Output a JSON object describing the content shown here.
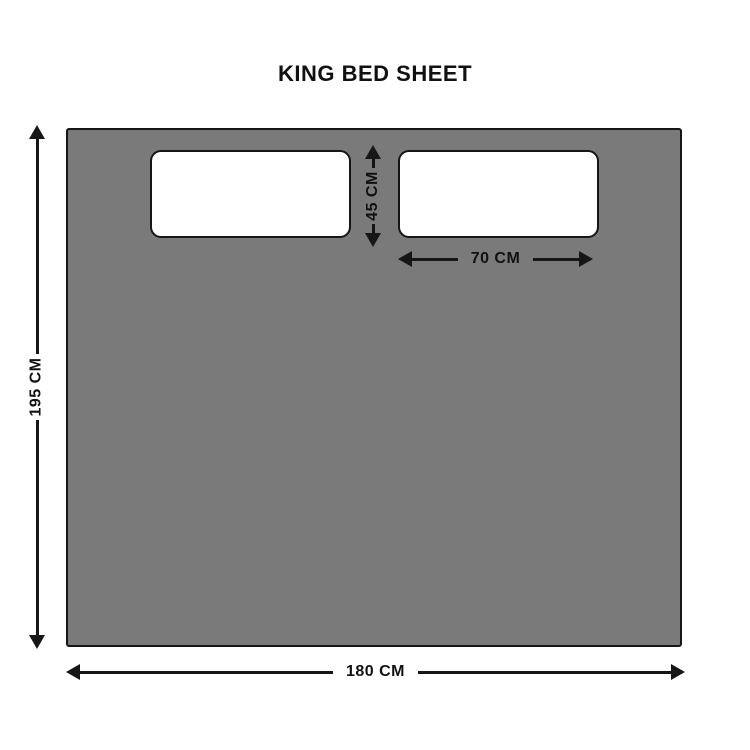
{
  "title": "KING BED SHEET",
  "dimensions": {
    "sheet_height": "195 CM",
    "sheet_width": "180 CM",
    "pillow_height": "45 CM",
    "pillow_width": "70 CM"
  },
  "colors": {
    "sheet_fill": "#7a7a7a",
    "pillow_fill": "#ffffff",
    "outline": "#161616",
    "text": "#111111",
    "background": "#ffffff"
  }
}
